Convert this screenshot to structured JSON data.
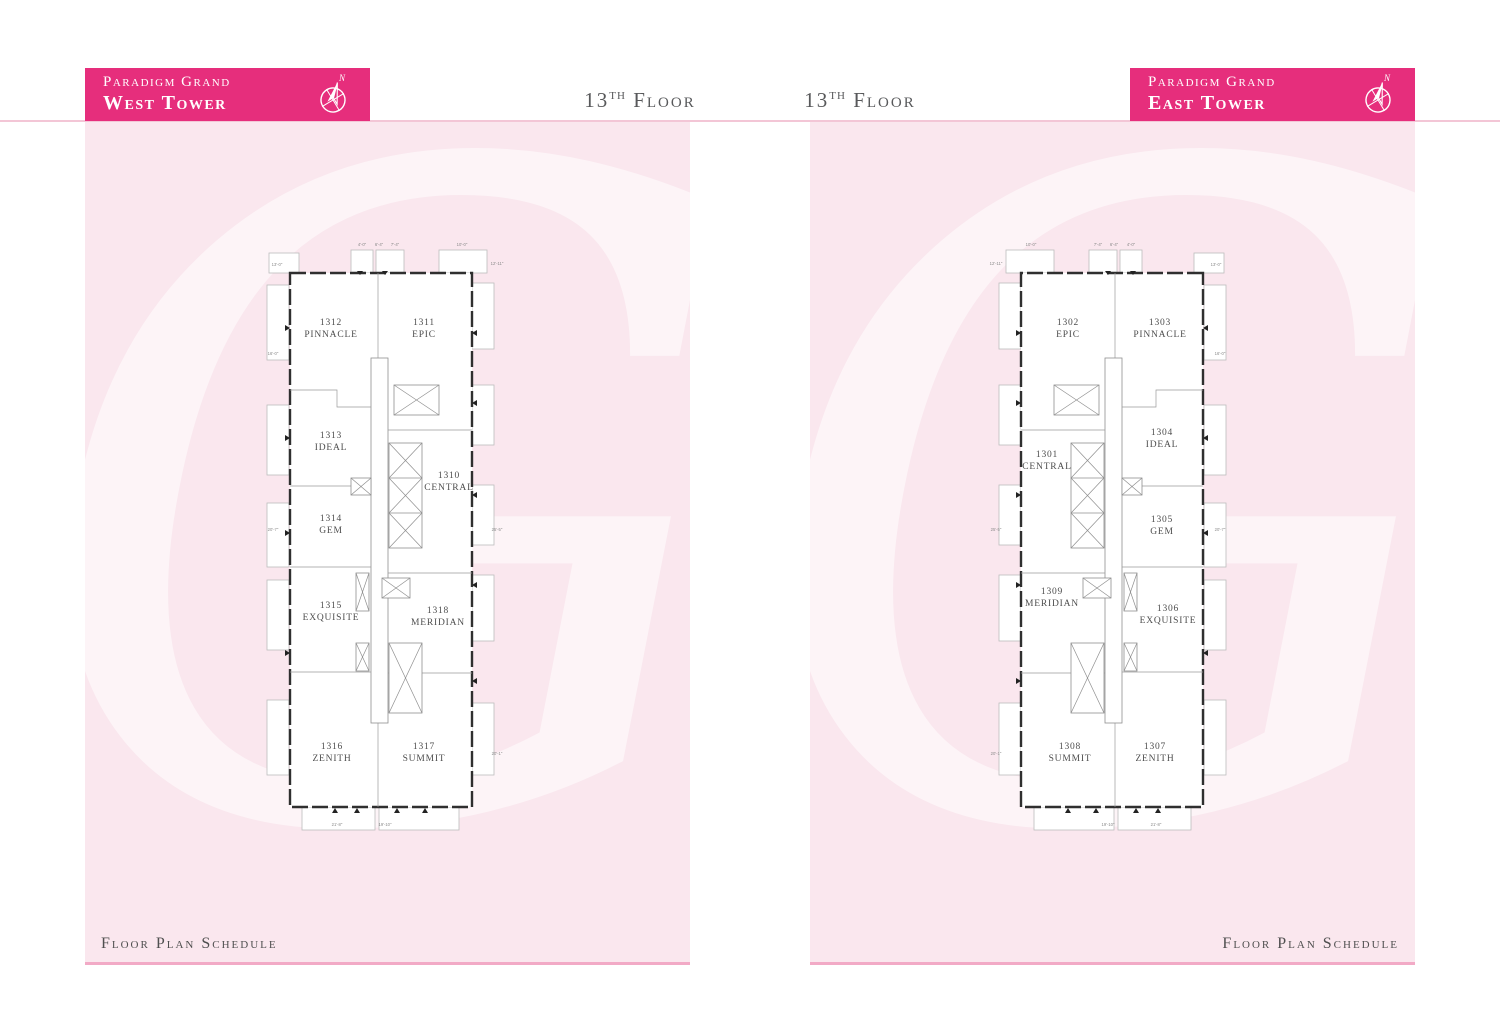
{
  "colors": {
    "accent_magenta": "#e62e7c",
    "panel_pink": "#fae7ee",
    "rule_pink": "#f3c6d6",
    "border_pink": "#f2aac6",
    "text_dark": "#4d4d4d"
  },
  "west": {
    "brand": "Paradigm Grand",
    "tower": "West Tower",
    "compass_n": "N",
    "floor": {
      "num": "13",
      "ord": "TH",
      "word": "Floor"
    },
    "footer": "Floor Plan Schedule",
    "units": [
      {
        "number": "1312",
        "name": "PINNACLE"
      },
      {
        "number": "1311",
        "name": "EPIC"
      },
      {
        "number": "1313",
        "name": "IDEAL"
      },
      {
        "number": "1310",
        "name": "CENTRAL"
      },
      {
        "number": "1314",
        "name": "GEM"
      },
      {
        "number": "1315",
        "name": "EXQUISITE"
      },
      {
        "number": "1318",
        "name": "MERIDIAN"
      },
      {
        "number": "1316",
        "name": "ZENITH"
      },
      {
        "number": "1317",
        "name": "SUMMIT"
      }
    ],
    "dims": [
      "13'-0\"",
      "12'-11\"",
      "4'-0\"",
      "6'-4\"",
      "7'-4\"",
      "10'-0\"",
      "16'-0\"",
      "20'-7\"",
      "25'-5\"",
      "21'-8\"",
      "19'-10\"",
      "20'-1\""
    ]
  },
  "east": {
    "brand": "Paradigm Grand",
    "tower": "East Tower",
    "compass_n": "N",
    "floor": {
      "num": "13",
      "ord": "TH",
      "word": "Floor"
    },
    "footer": "Floor Plan Schedule",
    "units": [
      {
        "number": "1302",
        "name": "EPIC"
      },
      {
        "number": "1303",
        "name": "PINNACLE"
      },
      {
        "number": "1301",
        "name": "CENTRAL"
      },
      {
        "number": "1304",
        "name": "IDEAL"
      },
      {
        "number": "1305",
        "name": "GEM"
      },
      {
        "number": "1309",
        "name": "MERIDIAN"
      },
      {
        "number": "1306",
        "name": "EXQUISITE"
      },
      {
        "number": "1308",
        "name": "SUMMIT"
      },
      {
        "number": "1307",
        "name": "ZENITH"
      }
    ],
    "dims": [
      "13'-0\"",
      "12'-11\"",
      "4'-0\"",
      "6'-4\"",
      "7'-4\"",
      "10'-0\"",
      "16'-0\"",
      "20'-7\"",
      "25'-5\"",
      "21'-8\"",
      "19'-10\"",
      "20'-1\""
    ]
  },
  "watermark_glyph": "G"
}
